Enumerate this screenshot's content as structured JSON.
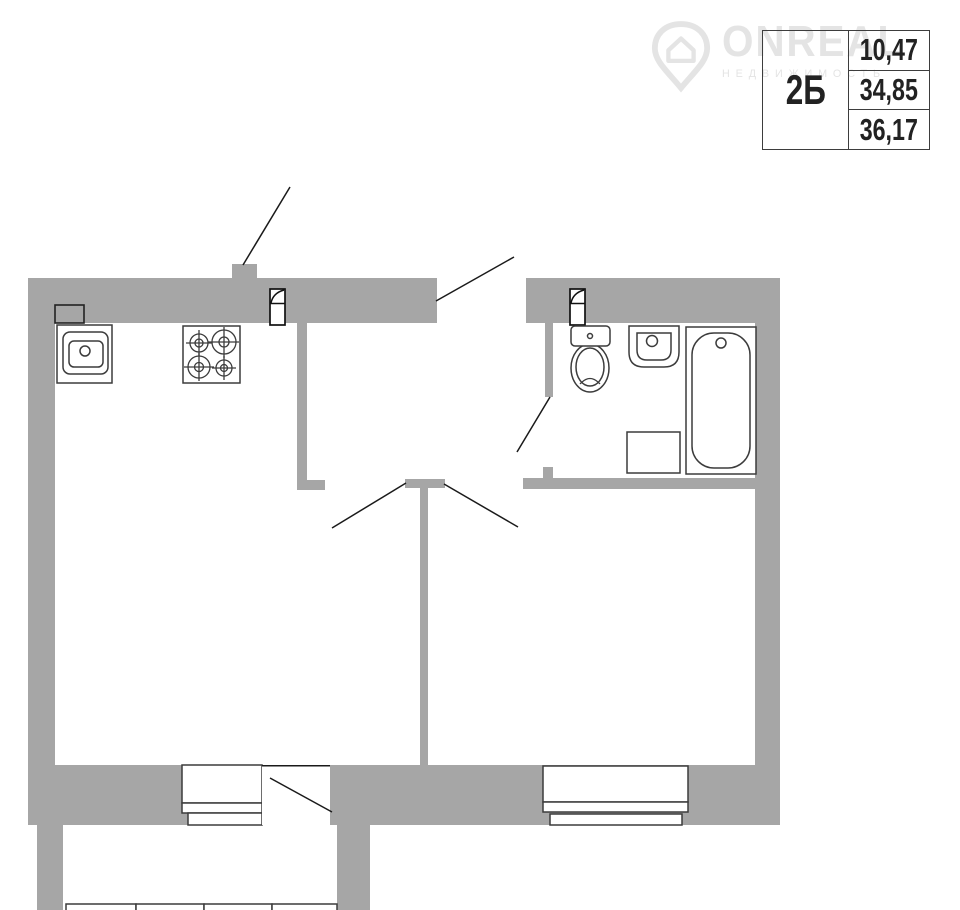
{
  "page": {
    "background": "#ffffff"
  },
  "watermark": {
    "brand": "ONREAL",
    "subtitle": "НЕДВИЖИМОСТЬ",
    "icon": "location-pin-house-icon",
    "color": "#e4e4e4"
  },
  "info_table": {
    "unit_label": "2Б",
    "values": [
      "10,47",
      "34,85",
      "36,17"
    ]
  },
  "floor_plan": {
    "type": "apartment-floor-plan",
    "wall_color": "#a6a6a6",
    "fixture_outline_color": "#3c3c3c",
    "door_line_color": "#1a1a1a",
    "fixtures": [
      "kitchen-sink",
      "gas-stove-4-burner",
      "kitchen-vent-duct",
      "bathroom-vent-duct",
      "toilet",
      "wash-basin",
      "bathtub",
      "washing-machine",
      "living-room-window",
      "balcony-door",
      "bedroom-window",
      "balcony-glazing",
      "entry-door-opening"
    ]
  }
}
